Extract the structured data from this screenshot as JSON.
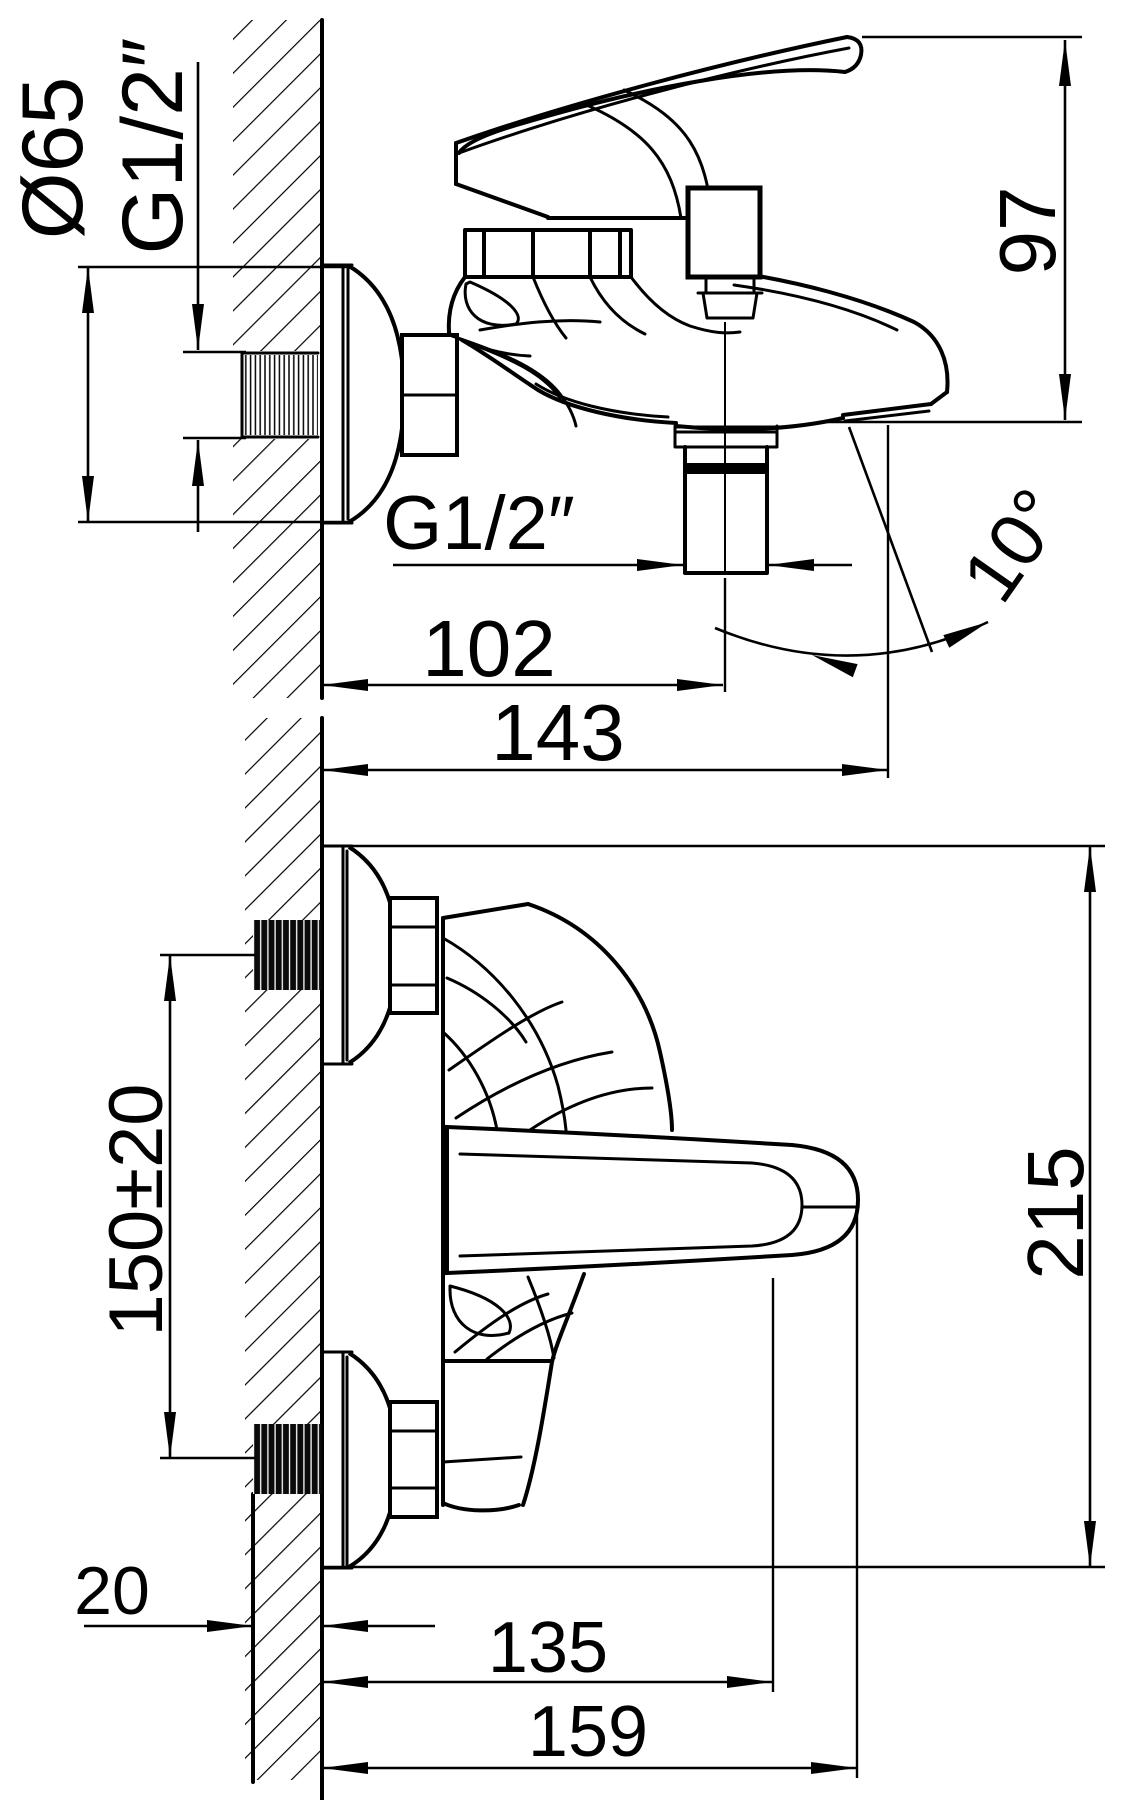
{
  "page": {
    "background": "#ffffff",
    "line_color": "#000000"
  },
  "drawing": {
    "kind": "technical dimension drawing",
    "subject": "wall-mounted single-lever bath/shower mixer, installation dimensions",
    "views": [
      {
        "name": "side view",
        "dimensions": [
          "Ø65",
          "G1/2″",
          "97",
          "G1/2″",
          "102",
          "143",
          "10°"
        ]
      },
      {
        "name": "front view",
        "dimensions": [
          "150±20",
          "215",
          "20",
          "135",
          "159"
        ]
      }
    ]
  },
  "dims": {
    "dia65": "Ø65",
    "g12_wall": "G1/2″",
    "h97": "97",
    "g12_outlet": "G1/2″",
    "len102": "102",
    "len143": "143",
    "ang10": "10°",
    "span150": "150±20",
    "h215": "215",
    "wall20": "20",
    "len135": "135",
    "len159": "159"
  }
}
